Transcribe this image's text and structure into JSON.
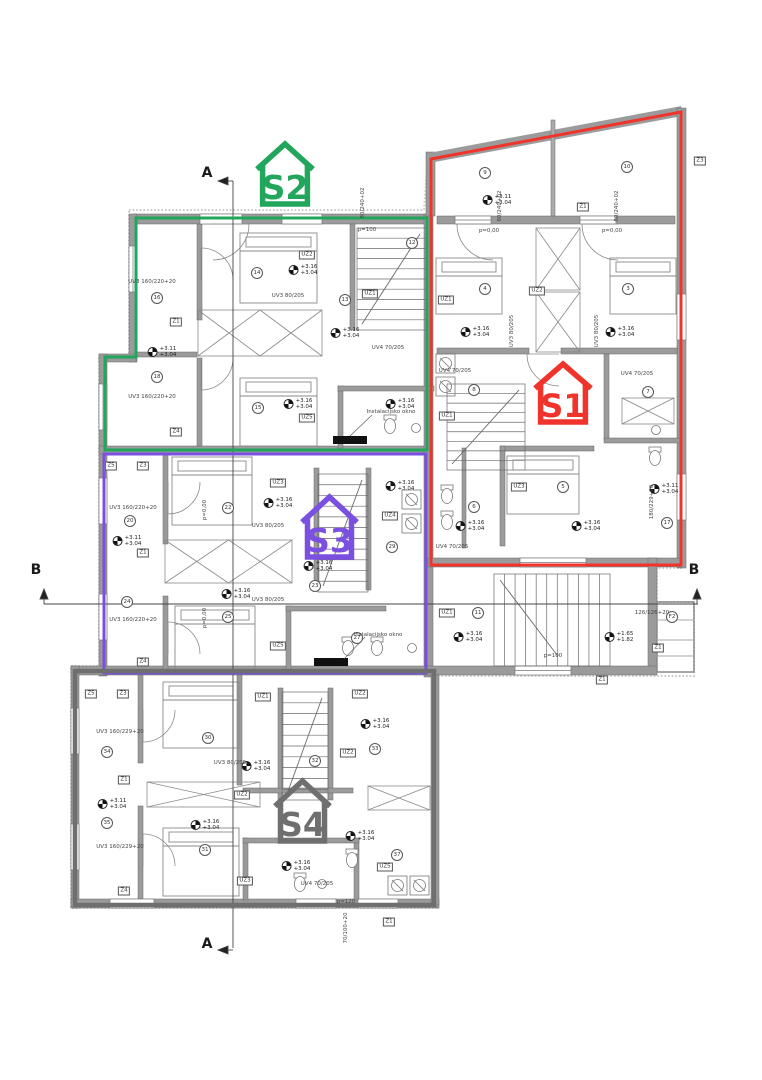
{
  "plan": {
    "units": [
      {
        "id": "s1",
        "label": "S1",
        "color": "#f0342b",
        "x": 535,
        "y": 364,
        "w": 56,
        "h": 58
      },
      {
        "id": "s2",
        "label": "S2",
        "color": "#22a65b",
        "x": 257,
        "y": 144,
        "w": 56,
        "h": 60
      },
      {
        "id": "s3",
        "label": "S3",
        "color": "#7b4fe0",
        "x": 302,
        "y": 497,
        "w": 55,
        "h": 60
      },
      {
        "id": "s4",
        "label": "S4",
        "color": "#6f6f6f",
        "x": 275,
        "y": 781,
        "w": 55,
        "h": 60
      }
    ],
    "section_markers": [
      {
        "label": "A",
        "x": 207,
        "y": 173
      },
      {
        "label": "A",
        "x": 207,
        "y": 944
      },
      {
        "label": "B",
        "x": 36,
        "y": 570
      },
      {
        "label": "B",
        "x": 694,
        "y": 570
      }
    ],
    "annotations": [
      {
        "t": "e",
        "x": 162,
        "y": 352,
        "a": "+3.11",
        "b": "+3.04"
      },
      {
        "t": "e",
        "x": 303,
        "y": 270,
        "a": "+3.16",
        "b": "+3.04"
      },
      {
        "t": "e",
        "x": 345,
        "y": 333,
        "a": "+3.16",
        "b": "+3.04"
      },
      {
        "t": "e",
        "x": 298,
        "y": 404,
        "a": "+3.16",
        "b": "+3.04"
      },
      {
        "t": "e",
        "x": 400,
        "y": 404,
        "a": "+3.16",
        "b": "+3.04"
      },
      {
        "t": "e",
        "x": 497,
        "y": 200,
        "a": "+3.11",
        "b": "+3.04"
      },
      {
        "t": "e",
        "x": 475,
        "y": 332,
        "a": "+3.16",
        "b": "+3.04"
      },
      {
        "t": "e",
        "x": 620,
        "y": 332,
        "a": "+3.16",
        "b": "+3.04"
      },
      {
        "t": "e",
        "x": 470,
        "y": 526,
        "a": "+3.16",
        "b": "+3.04"
      },
      {
        "t": "e",
        "x": 586,
        "y": 526,
        "a": "+3.16",
        "b": "+3.04"
      },
      {
        "t": "e",
        "x": 664,
        "y": 489,
        "a": "+3.11",
        "b": "+3.04"
      },
      {
        "t": "e",
        "x": 468,
        "y": 637,
        "a": "+3.16",
        "b": "+3.04"
      },
      {
        "t": "e",
        "x": 619,
        "y": 637,
        "a": "+1.65",
        "b": "+1.82"
      },
      {
        "t": "e",
        "x": 127,
        "y": 541,
        "a": "+3.11",
        "b": "+3.04"
      },
      {
        "t": "e",
        "x": 278,
        "y": 503,
        "a": "+3.16",
        "b": "+3.04"
      },
      {
        "t": "e",
        "x": 318,
        "y": 566,
        "a": "+3.16",
        "b": "+3.04"
      },
      {
        "t": "e",
        "x": 236,
        "y": 594,
        "a": "+3.16",
        "b": "+3.04"
      },
      {
        "t": "e",
        "x": 400,
        "y": 486,
        "a": "+3.16",
        "b": "+3.04"
      },
      {
        "t": "e",
        "x": 112,
        "y": 804,
        "a": "+3.11",
        "b": "+3.04"
      },
      {
        "t": "e",
        "x": 256,
        "y": 766,
        "a": "+3.16",
        "b": "+3.04"
      },
      {
        "t": "e",
        "x": 205,
        "y": 825,
        "a": "+3.16",
        "b": "+3.04"
      },
      {
        "t": "e",
        "x": 296,
        "y": 866,
        "a": "+3.16",
        "b": "+3.04"
      },
      {
        "t": "e",
        "x": 375,
        "y": 724,
        "a": "+3.16",
        "b": "+3.04"
      },
      {
        "t": "e",
        "x": 360,
        "y": 836,
        "a": "+3.16",
        "b": "+3.04"
      },
      {
        "t": "c",
        "x": 157,
        "y": 298,
        "s": "16"
      },
      {
        "t": "c",
        "x": 157,
        "y": 377,
        "s": "18"
      },
      {
        "t": "c",
        "x": 257,
        "y": 273,
        "s": "14"
      },
      {
        "t": "c",
        "x": 258,
        "y": 408,
        "s": "15"
      },
      {
        "t": "c",
        "x": 345,
        "y": 300,
        "s": "13"
      },
      {
        "t": "c",
        "x": 412,
        "y": 243,
        "s": "12"
      },
      {
        "t": "c",
        "x": 485,
        "y": 173,
        "s": "9"
      },
      {
        "t": "c",
        "x": 627,
        "y": 167,
        "s": "10"
      },
      {
        "t": "c",
        "x": 485,
        "y": 289,
        "s": "4"
      },
      {
        "t": "c",
        "x": 628,
        "y": 289,
        "s": "3"
      },
      {
        "t": "c",
        "x": 474,
        "y": 390,
        "s": "8"
      },
      {
        "t": "c",
        "x": 648,
        "y": 392,
        "s": "7"
      },
      {
        "t": "c",
        "x": 563,
        "y": 487,
        "s": "5"
      },
      {
        "t": "c",
        "x": 474,
        "y": 507,
        "s": "6"
      },
      {
        "t": "c",
        "x": 667,
        "y": 523,
        "s": "17"
      },
      {
        "t": "c",
        "x": 478,
        "y": 613,
        "s": "11"
      },
      {
        "t": "c",
        "x": 672,
        "y": 617,
        "s": "F2"
      },
      {
        "t": "c",
        "x": 130,
        "y": 521,
        "s": "20"
      },
      {
        "t": "c",
        "x": 127,
        "y": 602,
        "s": "24"
      },
      {
        "t": "c",
        "x": 228,
        "y": 508,
        "s": "22"
      },
      {
        "t": "c",
        "x": 228,
        "y": 617,
        "s": "25"
      },
      {
        "t": "c",
        "x": 315,
        "y": 586,
        "s": "23"
      },
      {
        "t": "c",
        "x": 392,
        "y": 547,
        "s": "29"
      },
      {
        "t": "c",
        "x": 357,
        "y": 638,
        "s": "27"
      },
      {
        "t": "c",
        "x": 107,
        "y": 752,
        "s": "34"
      },
      {
        "t": "c",
        "x": 107,
        "y": 823,
        "s": "35"
      },
      {
        "t": "c",
        "x": 208,
        "y": 738,
        "s": "30"
      },
      {
        "t": "c",
        "x": 205,
        "y": 850,
        "s": "31"
      },
      {
        "t": "c",
        "x": 375,
        "y": 749,
        "s": "33"
      },
      {
        "t": "c",
        "x": 315,
        "y": 761,
        "s": "32"
      },
      {
        "t": "c",
        "x": 397,
        "y": 855,
        "s": "37"
      },
      {
        "t": "b",
        "x": 176,
        "y": 322,
        "s": "Z1"
      },
      {
        "t": "b",
        "x": 176,
        "y": 432,
        "s": "Z4"
      },
      {
        "t": "b",
        "x": 307,
        "y": 255,
        "s": "UZ2"
      },
      {
        "t": "b",
        "x": 307,
        "y": 418,
        "s": "UZ5"
      },
      {
        "t": "b",
        "x": 370,
        "y": 294,
        "s": "UZ1"
      },
      {
        "t": "b",
        "x": 583,
        "y": 207,
        "s": "Z1"
      },
      {
        "t": "b",
        "x": 700,
        "y": 161,
        "s": "Z3"
      },
      {
        "t": "b",
        "x": 537,
        "y": 291,
        "s": "UZ2"
      },
      {
        "t": "b",
        "x": 446,
        "y": 300,
        "s": "UZ1"
      },
      {
        "t": "b",
        "x": 519,
        "y": 487,
        "s": "UZ3"
      },
      {
        "t": "b",
        "x": 447,
        "y": 416,
        "s": "UZ1"
      },
      {
        "t": "b",
        "x": 447,
        "y": 613,
        "s": "UZ1"
      },
      {
        "t": "b",
        "x": 658,
        "y": 648,
        "s": "Z1"
      },
      {
        "t": "b",
        "x": 602,
        "y": 680,
        "s": "Z1"
      },
      {
        "t": "b",
        "x": 111,
        "y": 466,
        "s": "Z5"
      },
      {
        "t": "b",
        "x": 143,
        "y": 466,
        "s": "Z3"
      },
      {
        "t": "b",
        "x": 143,
        "y": 553,
        "s": "Z1"
      },
      {
        "t": "b",
        "x": 143,
        "y": 662,
        "s": "Z4"
      },
      {
        "t": "b",
        "x": 278,
        "y": 483,
        "s": "UZ3"
      },
      {
        "t": "b",
        "x": 390,
        "y": 516,
        "s": "UZ4"
      },
      {
        "t": "b",
        "x": 278,
        "y": 646,
        "s": "UZ5"
      },
      {
        "t": "b",
        "x": 91,
        "y": 694,
        "s": "Z5"
      },
      {
        "t": "b",
        "x": 123,
        "y": 694,
        "s": "Z3"
      },
      {
        "t": "b",
        "x": 124,
        "y": 780,
        "s": "Z1"
      },
      {
        "t": "b",
        "x": 124,
        "y": 891,
        "s": "Z4"
      },
      {
        "t": "b",
        "x": 360,
        "y": 694,
        "s": "UZ2"
      },
      {
        "t": "b",
        "x": 348,
        "y": 753,
        "s": "UZ2"
      },
      {
        "t": "b",
        "x": 242,
        "y": 795,
        "s": "UZ2"
      },
      {
        "t": "b",
        "x": 245,
        "y": 881,
        "s": "UZ3"
      },
      {
        "t": "b",
        "x": 385,
        "y": 867,
        "s": "UZ5"
      },
      {
        "t": "b",
        "x": 263,
        "y": 697,
        "s": "UZ1"
      },
      {
        "t": "b",
        "x": 389,
        "y": 922,
        "s": "Z1"
      },
      {
        "t": "l",
        "x": 152,
        "y": 282,
        "s": "UV3 160/220+20"
      },
      {
        "t": "l",
        "x": 152,
        "y": 397,
        "s": "UV3 160/220+20"
      },
      {
        "t": "l",
        "x": 288,
        "y": 296,
        "s": "UV3 80/205"
      },
      {
        "t": "l",
        "x": 388,
        "y": 348,
        "s": "UV4 70/205"
      },
      {
        "t": "l",
        "x": 367,
        "y": 230,
        "s": "p=100"
      },
      {
        "t": "l",
        "x": 363,
        "y": 203,
        "s": "80/240+02",
        "r": 1
      },
      {
        "t": "l",
        "x": 391,
        "y": 412,
        "s": "Instalacijsko okno"
      },
      {
        "t": "l",
        "x": 489,
        "y": 231,
        "s": "p=0,00"
      },
      {
        "t": "l",
        "x": 612,
        "y": 231,
        "s": "p=0,00"
      },
      {
        "t": "l",
        "x": 500,
        "y": 206,
        "s": "80/240+02",
        "r": 1
      },
      {
        "t": "l",
        "x": 617,
        "y": 206,
        "s": "80/240+02",
        "r": 1
      },
      {
        "t": "l",
        "x": 512,
        "y": 331,
        "s": "UV3 80/205",
        "r": 1
      },
      {
        "t": "l",
        "x": 597,
        "y": 331,
        "s": "UV3 80/205",
        "r": 1
      },
      {
        "t": "l",
        "x": 455,
        "y": 371,
        "s": "UV4 70/205"
      },
      {
        "t": "l",
        "x": 637,
        "y": 374,
        "s": "UV4 70/205"
      },
      {
        "t": "l",
        "x": 452,
        "y": 547,
        "s": "UV4 70/205"
      },
      {
        "t": "l",
        "x": 652,
        "y": 502,
        "s": "180/229+20",
        "r": 1
      },
      {
        "t": "l",
        "x": 553,
        "y": 656,
        "s": "p=100"
      },
      {
        "t": "l",
        "x": 652,
        "y": 613,
        "s": "126/126+20"
      },
      {
        "t": "l",
        "x": 133,
        "y": 508,
        "s": "UV3 160/220+20"
      },
      {
        "t": "l",
        "x": 133,
        "y": 620,
        "s": "UV3 160/220+20"
      },
      {
        "t": "l",
        "x": 268,
        "y": 526,
        "s": "UV3 80/205"
      },
      {
        "t": "l",
        "x": 268,
        "y": 600,
        "s": "UV3 80/205"
      },
      {
        "t": "l",
        "x": 378,
        "y": 635,
        "s": "Instalacijsko okno"
      },
      {
        "t": "l",
        "x": 205,
        "y": 510,
        "s": "p=0,00",
        "r": 1
      },
      {
        "t": "l",
        "x": 205,
        "y": 618,
        "s": "p=0,00",
        "r": 1
      },
      {
        "t": "l",
        "x": 120,
        "y": 732,
        "s": "UV3 160/229+20"
      },
      {
        "t": "l",
        "x": 120,
        "y": 847,
        "s": "UV3 160/229+20"
      },
      {
        "t": "l",
        "x": 230,
        "y": 763,
        "s": "UV3 80/205"
      },
      {
        "t": "l",
        "x": 317,
        "y": 884,
        "s": "UV4 70/205"
      },
      {
        "t": "l",
        "x": 346,
        "y": 902,
        "s": "p=120"
      },
      {
        "t": "l",
        "x": 346,
        "y": 928,
        "s": "70/100+20",
        "r": 1
      }
    ]
  }
}
